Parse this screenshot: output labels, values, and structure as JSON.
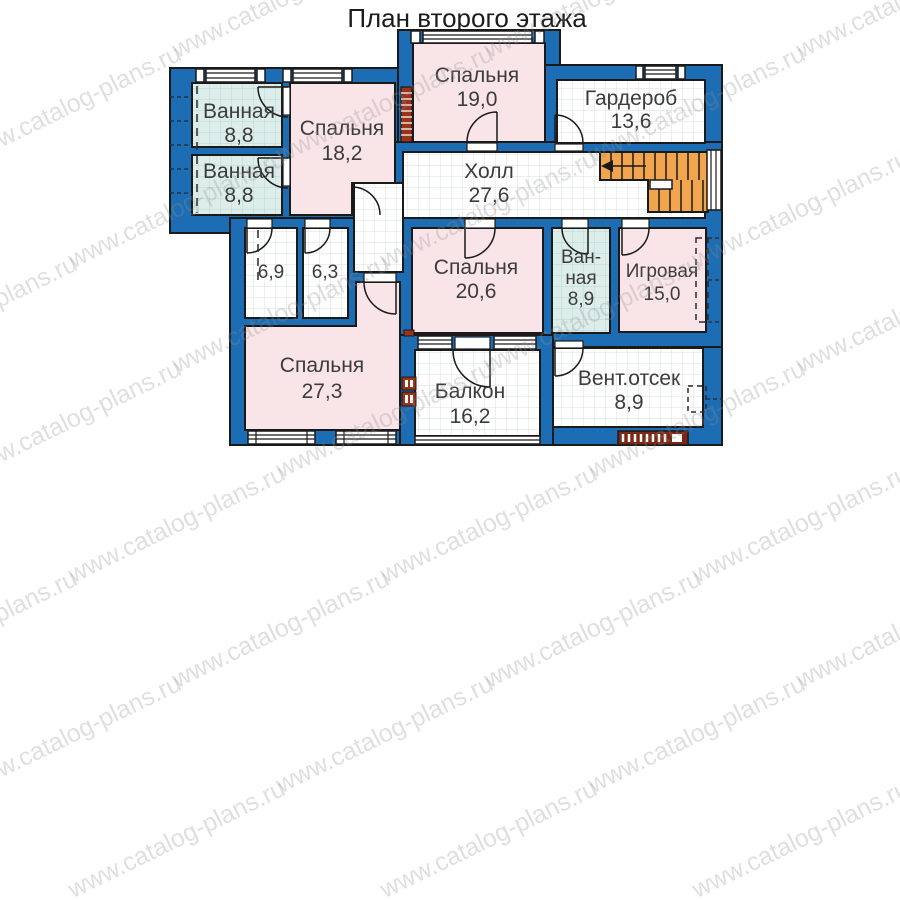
{
  "title": "План второго этажа",
  "watermark": {
    "text": "www.catalog-plans.ru"
  },
  "colors": {
    "wall_blue": "#1d6db5",
    "outline": "#1a1a1a",
    "room_pink": "#f9e4e8",
    "room_wet": "#ddeeea",
    "floor_grid": "#d9dfe2",
    "stairs_orange": "#f1a54f",
    "accent_brick": "#9a3318",
    "label_gray": "#3c3c3c"
  },
  "rooms": {
    "bath1": {
      "name": "Ванная",
      "area": "8,8"
    },
    "bath2": {
      "name": "Ванная",
      "area": "8,8"
    },
    "bedroom1": {
      "name": "Спальня",
      "area": "18,2"
    },
    "bedroom2": {
      "name": "Спальня",
      "area": "19,0"
    },
    "wardrobe": {
      "name": "Гардероб",
      "area": "13,6"
    },
    "hall": {
      "name": "Холл",
      "area": "27,6"
    },
    "room69": {
      "area": "6,9"
    },
    "room63": {
      "area": "6,3"
    },
    "bedroom3": {
      "name": "Спальня",
      "area": "20,6"
    },
    "bath3": {
      "line1": "Ван-",
      "line2": "ная",
      "area": "8,9"
    },
    "playroom": {
      "name": "Игровая",
      "area": "15,0"
    },
    "bedroom4": {
      "name": "Спальня",
      "area": "27,3"
    },
    "balcony": {
      "name": "Балкон",
      "area": "16,2"
    },
    "vent": {
      "name": "Вент.отсек",
      "area": "8,9"
    }
  }
}
